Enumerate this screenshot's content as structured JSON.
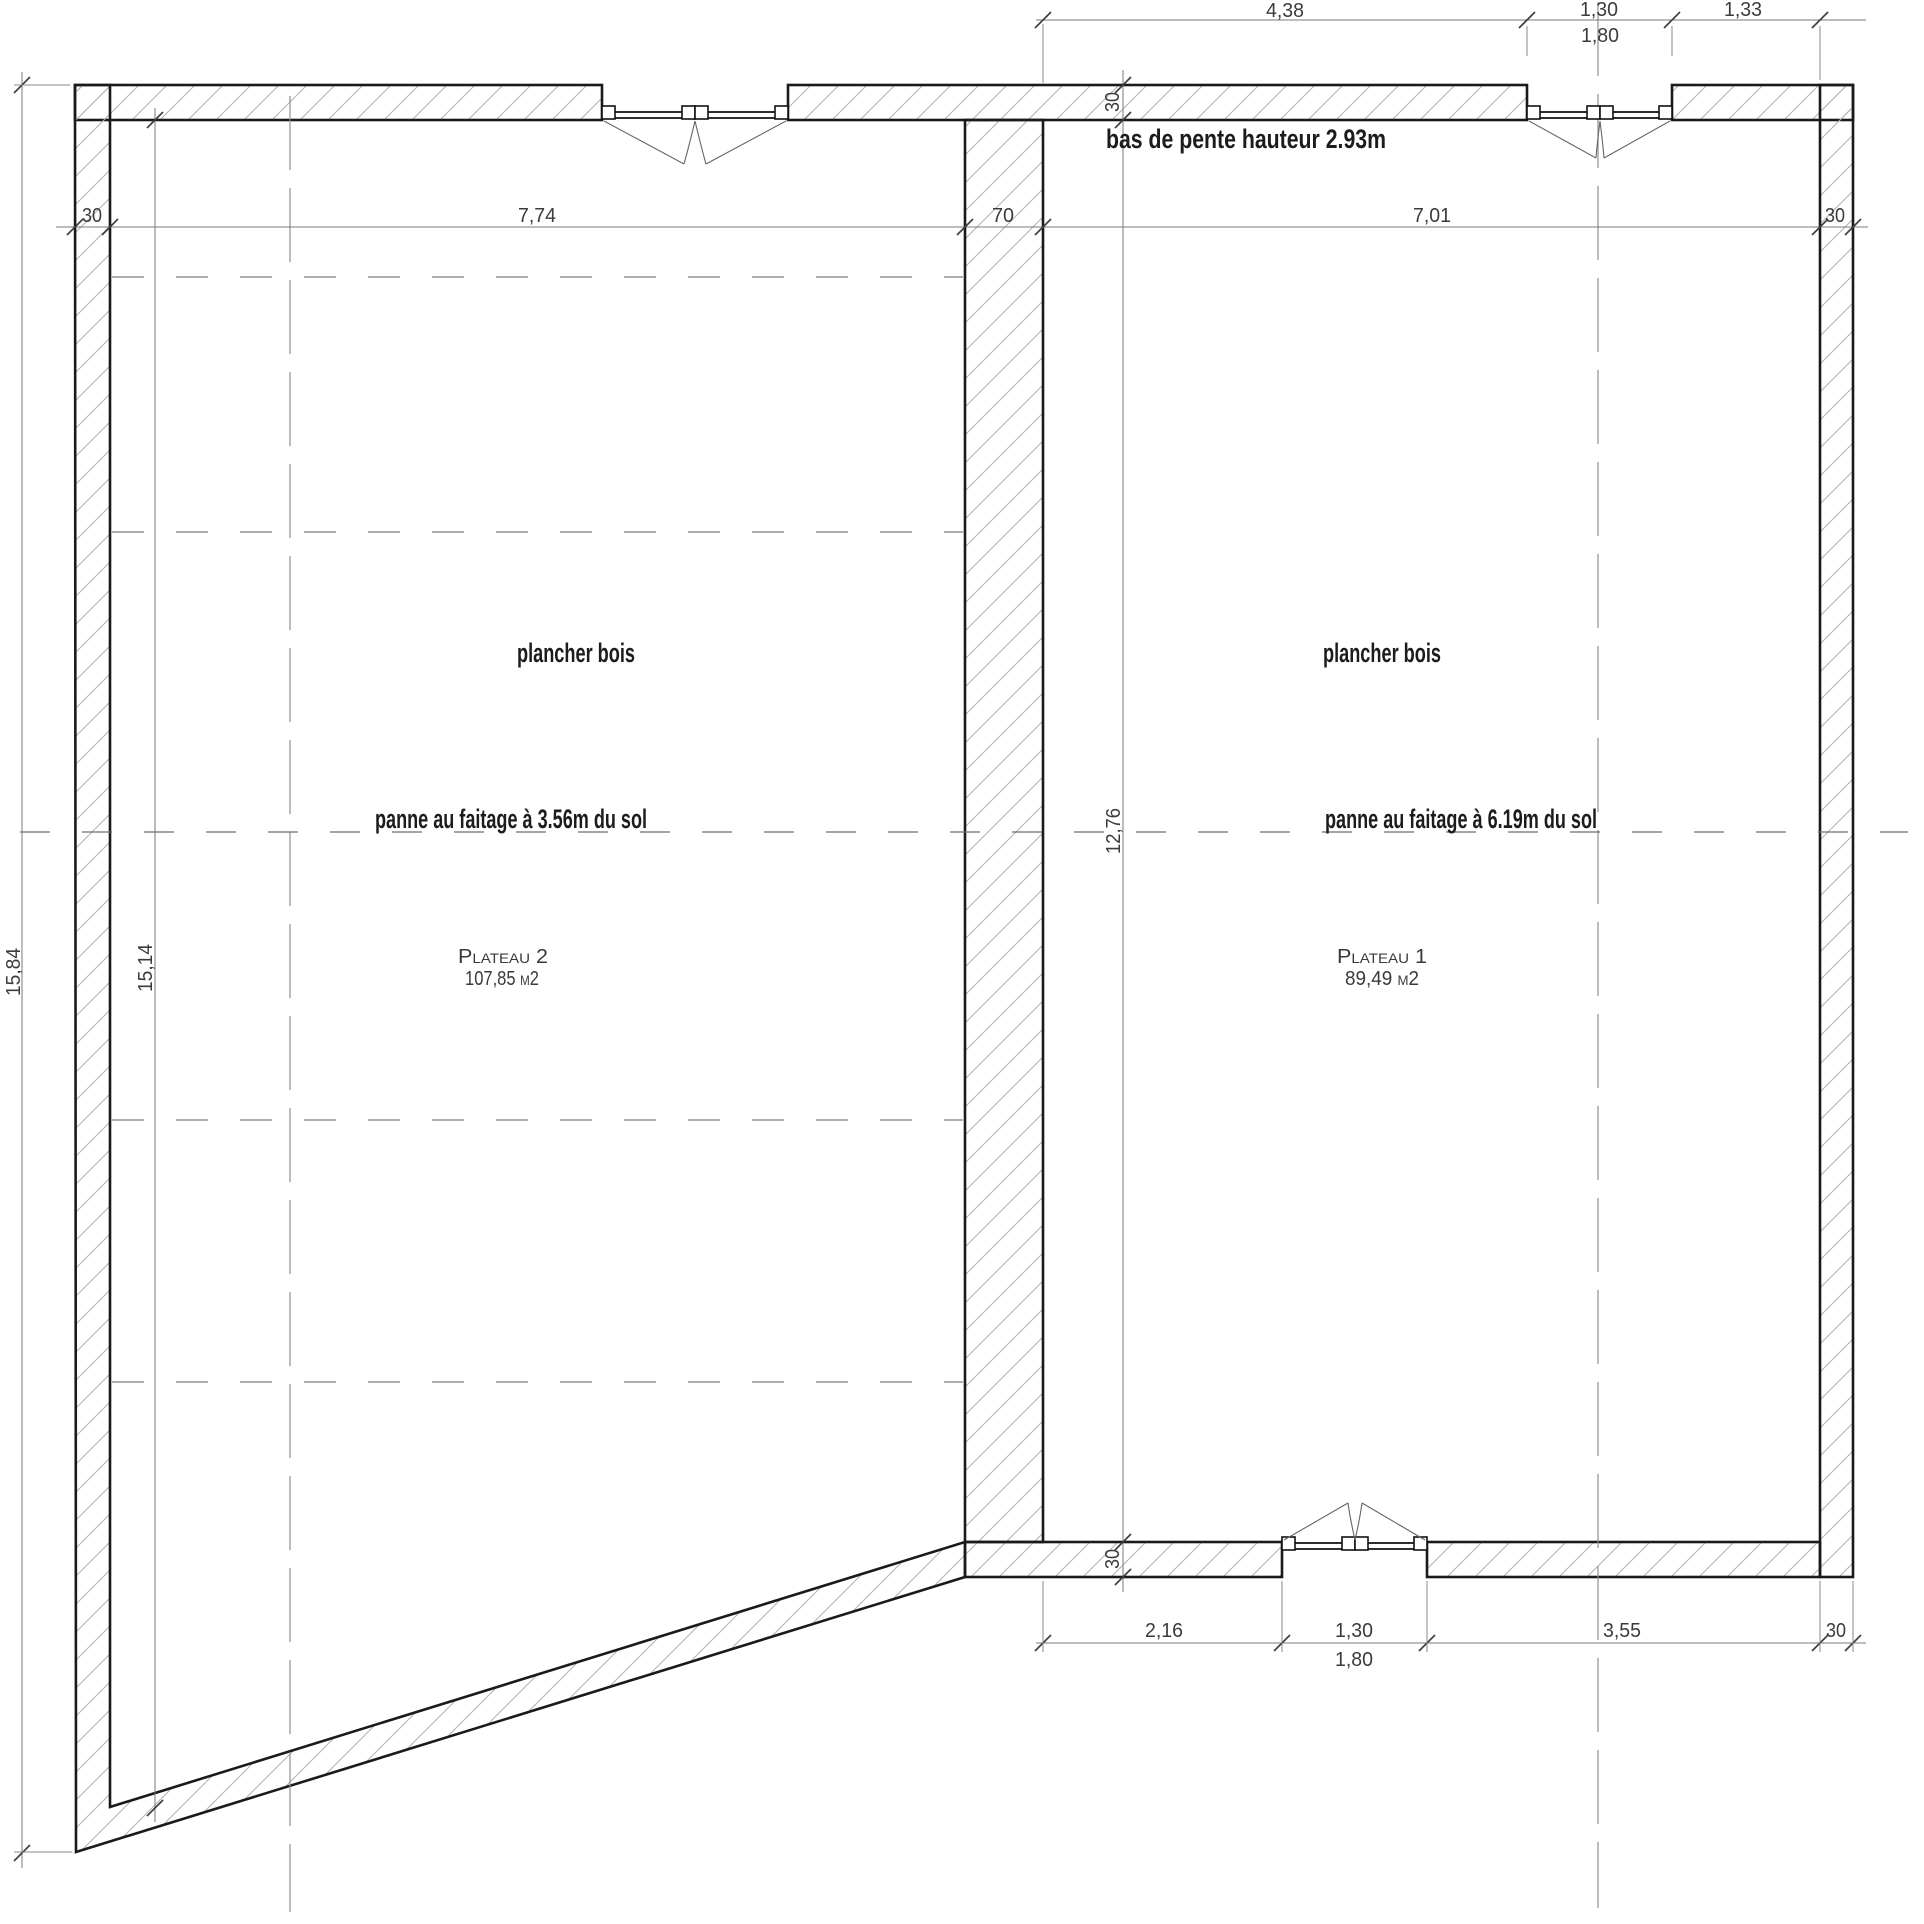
{
  "annotations": {
    "slope_note": "bas de pente hauteur 2.93m",
    "floor_left": "plancher bois",
    "floor_right": "plancher bois",
    "ridge_left": "panne au faitage à 3.56m du sol",
    "ridge_right": "panne au faitage à 6.19m du sol"
  },
  "rooms": [
    {
      "name": "Plateau 2",
      "area": "107,85 m2"
    },
    {
      "name": "Plateau 1",
      "area": "89,49 m2"
    }
  ],
  "dimensions": {
    "top": {
      "seg1": "4,38",
      "seg2": "1,30",
      "seg3": "1,33",
      "opening_total": "1,80"
    },
    "middle": {
      "wall_left": "30",
      "plateau2_width": "7,74",
      "wall_mid": "70",
      "plateau1_width": "7,01",
      "wall_right": "30"
    },
    "bottom": {
      "seg1": "2,16",
      "seg2": "1,30",
      "seg3": "3,55",
      "wall_right": "30",
      "opening_total": "1,80"
    },
    "left": {
      "outer_height": "15,84",
      "inner_height": "15,14"
    },
    "vertical_mid": {
      "wall_top": "30",
      "plateau1_height": "12,76",
      "wall_bottom": "30"
    }
  }
}
